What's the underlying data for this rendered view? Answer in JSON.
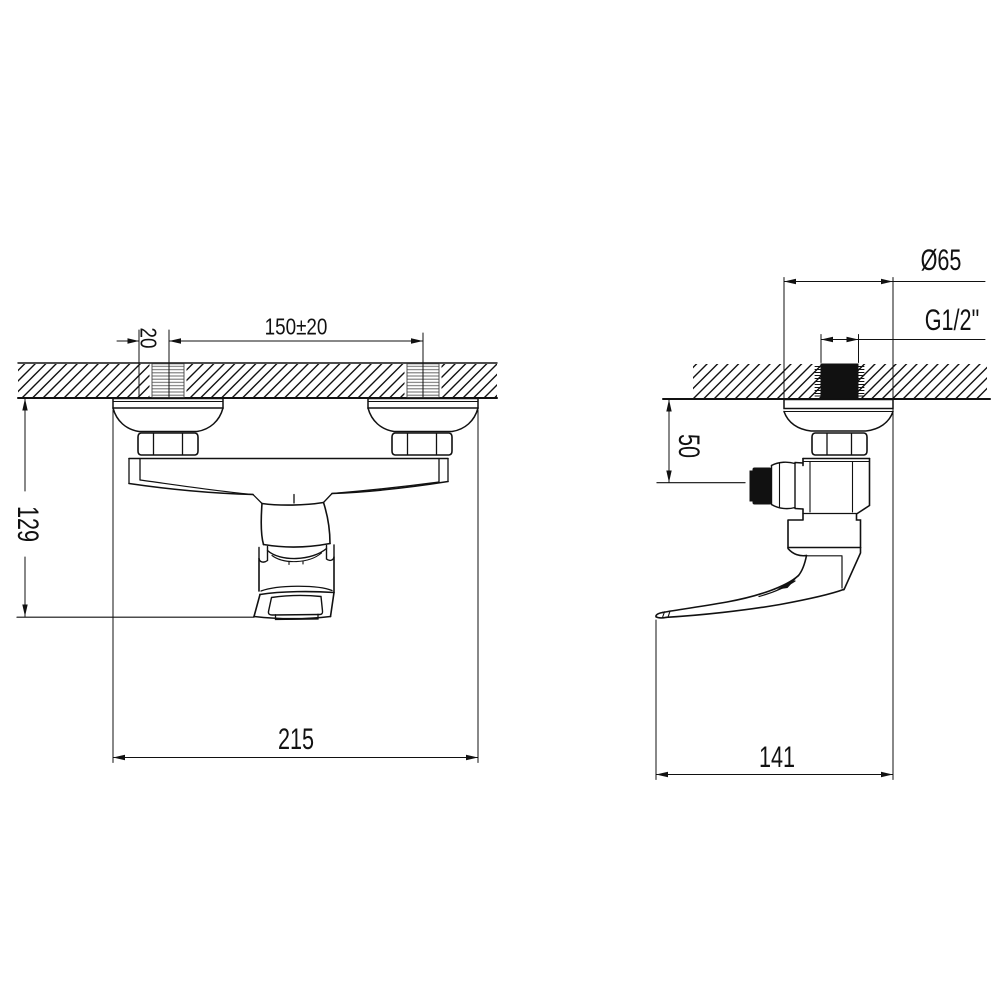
{
  "drawing": {
    "units": "mm",
    "front_view": {
      "thread_offset": "20",
      "inlet_spacing": "150±20",
      "height_below_wall": "129",
      "overall_width": "215"
    },
    "side_view": {
      "escutcheon_diameter": "Ø65",
      "connection_thread": "G1/2\"",
      "wall_to_outlet": "50",
      "overall_depth": "141"
    }
  }
}
